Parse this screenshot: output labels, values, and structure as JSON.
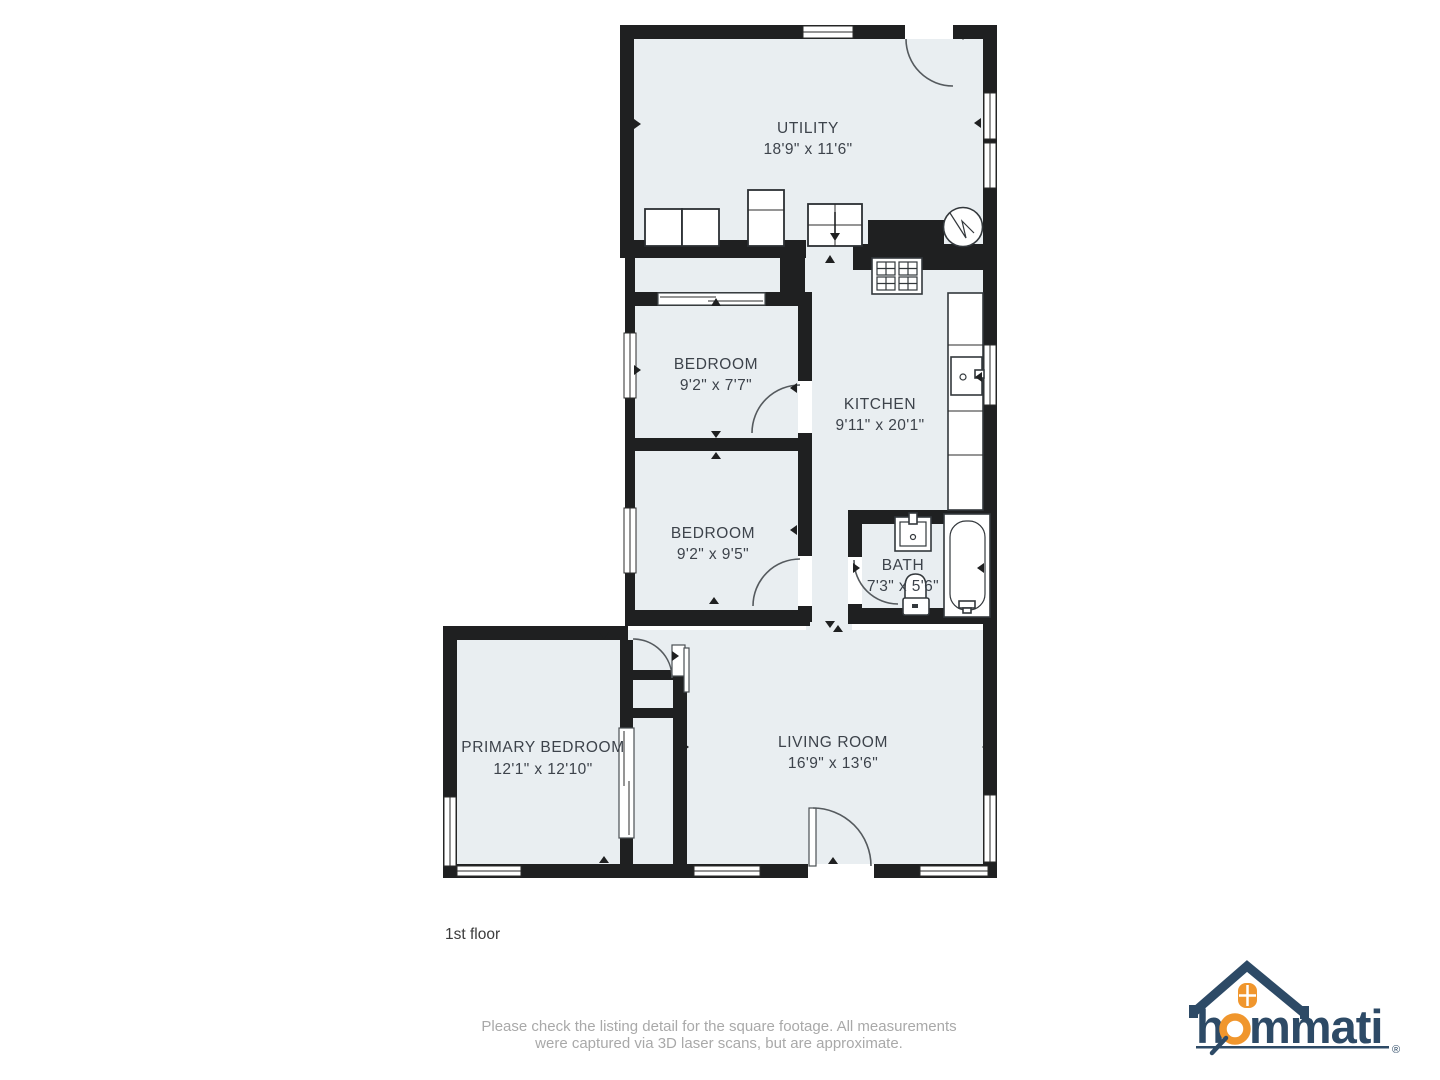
{
  "plan": {
    "floor_label": "1st floor",
    "rooms": [
      {
        "id": "utility",
        "name": "UTILITY",
        "dims": "18'9\" x 11'6\""
      },
      {
        "id": "bedroom-1",
        "name": "BEDROOM",
        "dims": "9'2\" x 7'7\""
      },
      {
        "id": "kitchen",
        "name": "KITCHEN",
        "dims": "9'11\" x 20'1\""
      },
      {
        "id": "bedroom-2",
        "name": "BEDROOM",
        "dims": "9'2\" x 9'5\""
      },
      {
        "id": "bath",
        "name": "BATH",
        "dims": "7'3\" x 5'6\""
      },
      {
        "id": "primary-bedroom",
        "name": "PRIMARY BEDROOM",
        "dims": "12'1\" x 12'10\""
      },
      {
        "id": "living-room",
        "name": "LIVING ROOM",
        "dims": "16'9\" x 13'6\""
      }
    ]
  },
  "footer": {
    "disclaimer_line1": "Please check the listing detail for the square footage. All measurements",
    "disclaimer_line2": "were captured via 3D laser scans, but are approximate."
  },
  "logo": {
    "brand": "hommati",
    "brand_part1": "h",
    "brand_part2": "mmati",
    "registered": "®"
  },
  "colors": {
    "floor_fill": "#e9eef1",
    "wall": "#1f2021",
    "label_text": "#3d434b",
    "floor_label_text": "#3c3c3c",
    "disclaimer_text": "#a9a9a9",
    "logo_navy": "#2d4a66",
    "logo_orange": "#f0962d"
  }
}
